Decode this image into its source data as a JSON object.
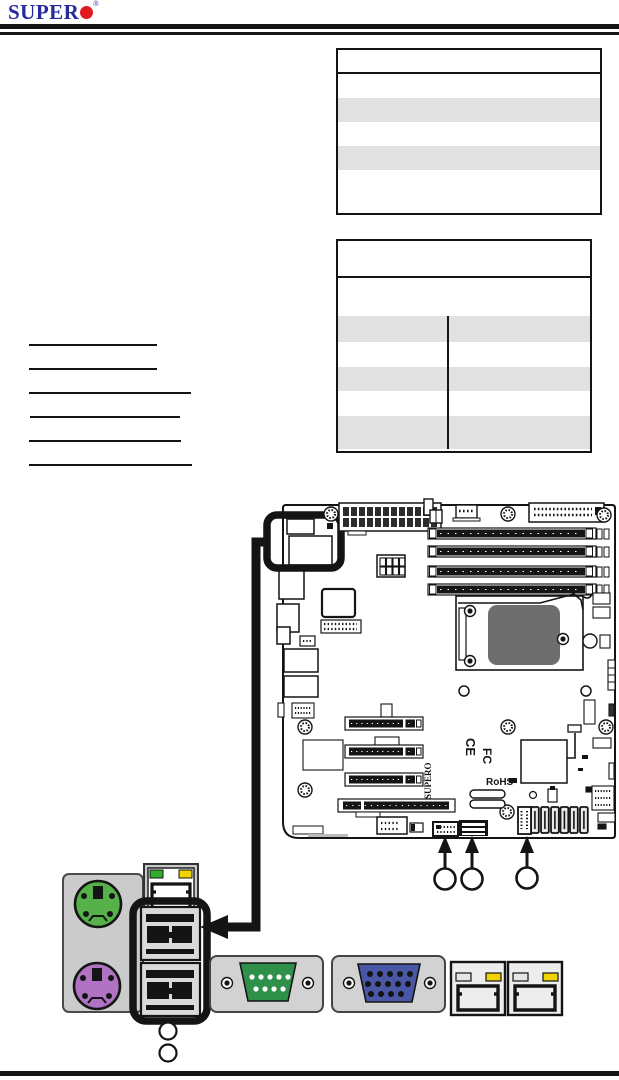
{
  "logo": {
    "text": "SUPER",
    "registered": "®",
    "dot_color": "#e11b22",
    "text_color": "#252a9c"
  },
  "tables": {
    "spec_table": {
      "header": "",
      "rows": [
        "",
        "",
        "",
        "",
        ""
      ]
    },
    "jumper_table": {
      "header": "",
      "intro_row": "",
      "rows": [
        {
          "left": "",
          "right": ""
        },
        {
          "left": "",
          "right": ""
        },
        {
          "left": "",
          "right": ""
        },
        {
          "left": "",
          "right": ""
        },
        {
          "left": "",
          "right": ""
        }
      ]
    }
  },
  "links": [
    "",
    "",
    "",
    "",
    "",
    ""
  ],
  "board": {
    "silkscreen": {
      "brand": "SUPERO",
      "ce_mark": "CE",
      "fcc_mark": "FC",
      "rohs_mark": "RoHS"
    },
    "callouts": [
      "",
      "",
      ""
    ]
  },
  "io_panel": {
    "callouts": [
      "",
      ""
    ]
  },
  "colors": {
    "logo_blue": "#252a9c",
    "logo_red": "#e11b22",
    "ps2_mouse_green": "#56b14b",
    "ps2_keyboard_purple": "#b072c2",
    "serial_green": "#2f9049",
    "vga_blue": "#4a57a7",
    "led_green": "#2fae2f",
    "led_yellow": "#f0d400",
    "panel_gray": "#cbcbcb",
    "table_stripe": "#e1e1e1"
  }
}
